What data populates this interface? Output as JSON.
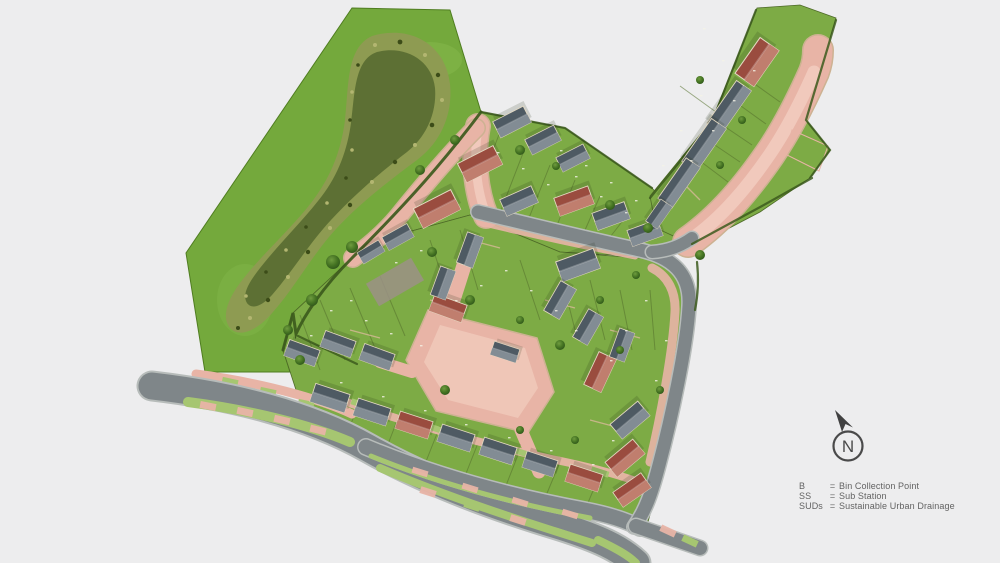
{
  "compass": {
    "label": "N"
  },
  "legend": {
    "items": [
      {
        "abbr": "B",
        "eq": "=",
        "meaning": "Bin Collection Point"
      },
      {
        "abbr": "SS",
        "eq": "=",
        "meaning": "Sub Station"
      },
      {
        "abbr": "SUDs",
        "eq": "=",
        "meaning": "Sustainable Urban Drainage"
      }
    ]
  },
  "colors": {
    "background": "#ededee",
    "grass_open": "#74a93c",
    "grass_plots": "#7dab45",
    "pond_outer": "#8e9b52",
    "pond_inner": "#5d7034",
    "road_asphalt": "#7f8689",
    "road_curb": "#b7bcba",
    "street_pink": "#e8b4a6",
    "street_pink_light": "#f2cdbf",
    "street_edge": "#cdb292",
    "verge_green": "#a6c671",
    "roof_gray_dark": "#4e5a63",
    "roof_gray_light": "#828c94",
    "roof_red_dark": "#9a4c3f",
    "roof_red_light": "#c07e6e",
    "wall_cream": "#e4d9c2",
    "hedge": "#3c5a1d",
    "tree_dark": "#2c511a",
    "legend_text": "#636363"
  }
}
